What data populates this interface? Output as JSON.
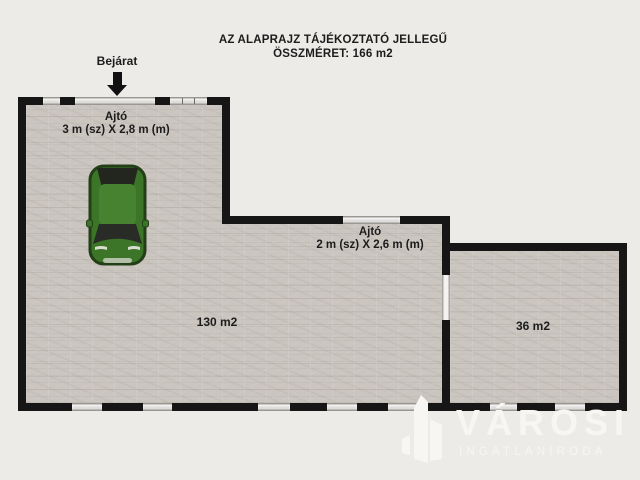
{
  "title": {
    "line1": "AZ ALAPRAJZ TÁJÉKOZTATÓ JELLEGŰ",
    "line2": "ÖSSZMÉRET: 166 m2"
  },
  "entrance": {
    "label": "Bejárat"
  },
  "doors": [
    {
      "name": "Ajtó",
      "size": "3 m (sz) X 2,8 m (m)"
    },
    {
      "name": "Ajtó",
      "size": "2 m (sz) X 2,6 m (m)"
    }
  ],
  "rooms": [
    {
      "area_label": "130 m2"
    },
    {
      "area_label": "36 m2"
    }
  ],
  "watermark": {
    "brand": "VÁROSI",
    "tagline": "INGATLANIRODA"
  },
  "icons": {
    "entrance-arrow-icon": "▼",
    "car-top-view-icon": "green car viewed from above",
    "buildings-logo-icon": "stylized white buildings"
  },
  "colors": {
    "background": "#edebe8",
    "floor": "#cac5bf",
    "wall": "#161616",
    "opening": "#dedcd9",
    "text": "#1c1c1c",
    "car_body": "#3c7527",
    "car_glass": "#282b26",
    "watermark": "#f7f6f2"
  }
}
